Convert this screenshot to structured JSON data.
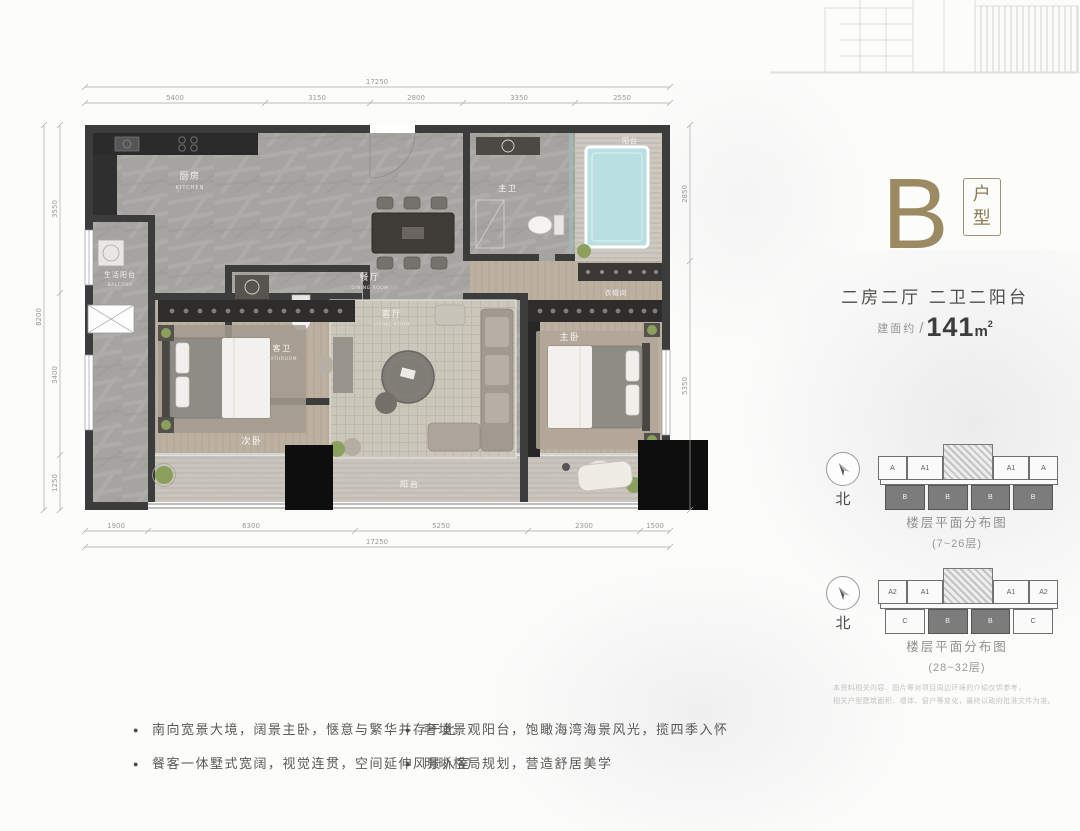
{
  "panel": {
    "unit_letter": "B",
    "unit_type_char1": "户",
    "unit_type_char2": "型",
    "rooms_summary": "二房二厅 二卫二阳台",
    "area_prefix": "建面约",
    "area_slash": "/",
    "area_value": "141",
    "area_unit": "m",
    "area_sup": "2",
    "disclaimer_line1": "本资料相关内容、图片等对项目周边环境的介绍仅供参考，",
    "disclaimer_line2": "相关户型建筑面积、墙体、窗户等变化，最终以政府批准文件为准。"
  },
  "diagrams": [
    {
      "north": "北",
      "caption": "楼层平面分布图",
      "range": "(7~26层)",
      "top_units": [
        "A",
        "A1",
        "A1",
        "A"
      ],
      "bottom_units": [
        "B",
        "B",
        "B",
        "B"
      ]
    },
    {
      "north": "北",
      "caption": "楼层平面分布图",
      "range": "(28~32层)",
      "top_units": [
        "A2",
        "A1",
        "A1",
        "A2"
      ],
      "bottom_units": [
        "C",
        "B",
        "B",
        "C"
      ]
    }
  ],
  "features": {
    "left": [
      "南向宽景大境，阔景主卧，惬意与繁华并存于此",
      "餐客一体墅式宽阔，视觉连贯，空间延伸风景入室"
    ],
    "right": [
      "奢境景观阳台，饱瞰海湾海景风光，揽四季入怀",
      "明晰格局规划，营造舒居美学"
    ]
  },
  "floorplan": {
    "rooms": {
      "kitchen_cn": "厨房",
      "kitchen_en": "KITCHEN",
      "utility_cn": "生活阳台",
      "utility_en": "BALCONY",
      "guest_bath_cn": "客卫",
      "guest_bath_en": "BATHROOM",
      "dining_cn": "餐厅",
      "dining_en": "DINING ROOM",
      "living_cn": "客厅",
      "living_en": "LIVING ROOM",
      "bedroom2_cn": "次卧",
      "bedroom2_en": "BEDROOM",
      "master_cn": "主卧",
      "master_en": "MASTER BEDROOM",
      "master_bath_cn": "主卫",
      "cloak_cn": "衣帽间",
      "balcony_cn": "阳台",
      "balcony2_cn": "阳台"
    },
    "dims": {
      "top_overall": "17250",
      "top": [
        "5400",
        "3150",
        "2800",
        "3350",
        "2550"
      ],
      "bottom": [
        "1900",
        "6300",
        "5250",
        "2300",
        "1500"
      ],
      "bottom_overall": "17250",
      "left": [
        "3550",
        "3400",
        "1250"
      ],
      "left_overall": "8200",
      "right": [
        "2850",
        "5350"
      ]
    }
  },
  "colors": {
    "accent_bronze": "#9c8a62",
    "wall": "#3c3c3c",
    "tub": "#b9dfe2"
  }
}
